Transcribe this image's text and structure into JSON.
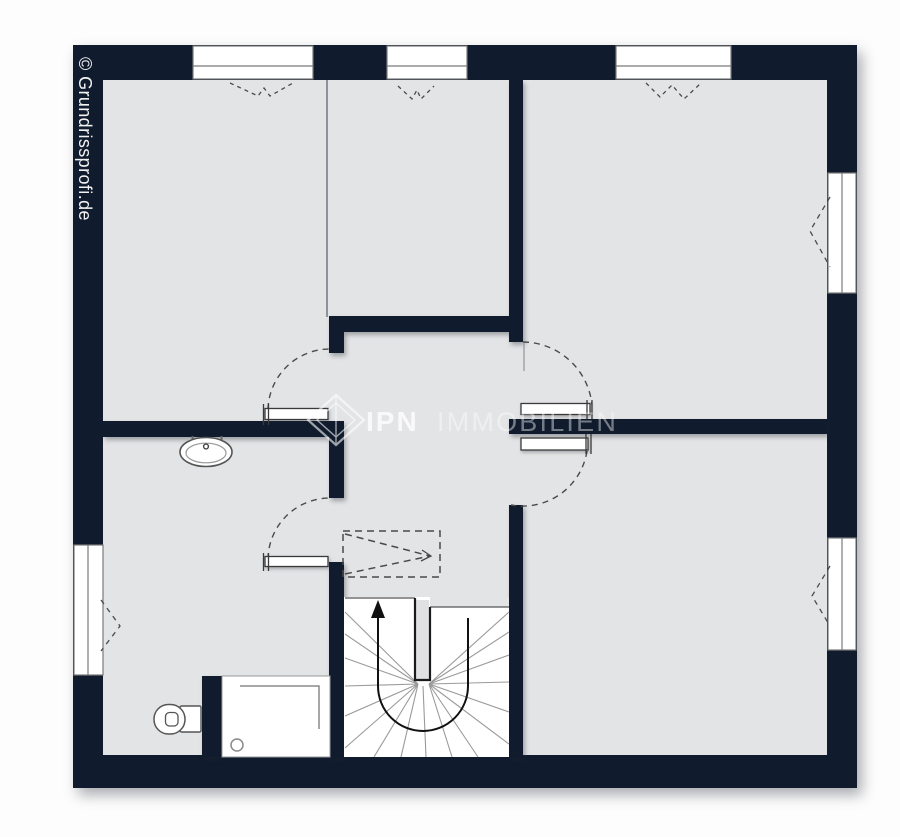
{
  "watermark": {
    "copyright": "© Grundrissprofi.de",
    "brand_primary": "IPN",
    "brand_secondary": "IMMOBILIEN"
  },
  "colors": {
    "wall": "#101c2e",
    "floor": "#e3e4e6",
    "page_background": "#ffffff",
    "window_fill": "#ffffff",
    "outline_gray": "#555555",
    "dashed_line": "#4a4a4a",
    "stair_tread_line": "#999999",
    "watermark_text": "#f2f2f2"
  },
  "plan": {
    "type": "floor-plan",
    "rooms": [
      {
        "name": "room-top-left",
        "label": ""
      },
      {
        "name": "room-top-middle",
        "label": ""
      },
      {
        "name": "room-top-right",
        "label": ""
      },
      {
        "name": "room-bottom-right",
        "label": ""
      },
      {
        "name": "bathroom",
        "label": ""
      },
      {
        "name": "hallway",
        "label": ""
      },
      {
        "name": "stairwell",
        "label": ""
      }
    ],
    "windows": [
      {
        "name": "window-top-left",
        "wall": "top"
      },
      {
        "name": "window-top-middle",
        "wall": "top"
      },
      {
        "name": "window-top-right",
        "wall": "top"
      },
      {
        "name": "window-right-upper",
        "wall": "right"
      },
      {
        "name": "window-right-lower",
        "wall": "right"
      },
      {
        "name": "window-left-lower",
        "wall": "left"
      }
    ],
    "doors": [
      {
        "name": "door-room-top-left",
        "swing": "arc"
      },
      {
        "name": "door-bathroom",
        "swing": "arc"
      },
      {
        "name": "door-room-top-right",
        "swing": "arc"
      },
      {
        "name": "door-room-bottom-right",
        "swing": "arc"
      }
    ],
    "fixtures": [
      {
        "name": "washbasin"
      },
      {
        "name": "toilet"
      },
      {
        "name": "shower-tray"
      },
      {
        "name": "winder-staircase",
        "walking_line_arrow": "up"
      }
    ],
    "symbols": [
      {
        "name": "dashed-clearance-rectangle"
      },
      {
        "name": "window-opening-chevrons"
      }
    ]
  }
}
